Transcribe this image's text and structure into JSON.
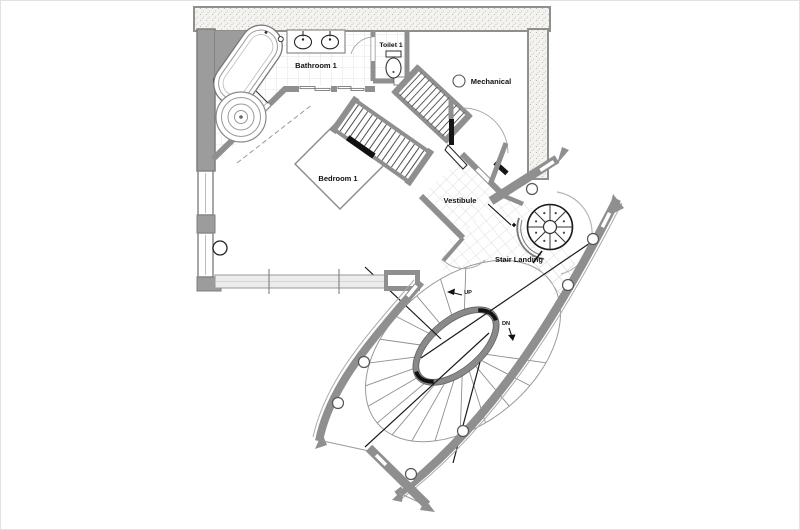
{
  "plan": {
    "rooms": [
      {
        "id": "bathroom",
        "label": "Bathroom 1"
      },
      {
        "id": "toilet",
        "label": "Toilet 1"
      },
      {
        "id": "mechanical",
        "label": "Mechanical"
      },
      {
        "id": "bedroom",
        "label": "Bedroom 1"
      },
      {
        "id": "vestibule",
        "label": "Vestibule"
      },
      {
        "id": "stair-landing",
        "label": "Stair Landing"
      }
    ],
    "annotations": {
      "up": "UP",
      "down": "DN"
    },
    "fixtures": [
      "bathtub",
      "shower",
      "vanity",
      "sinks",
      "toilet",
      "bed",
      "wardrobe",
      "spiral-stair",
      "elliptical-stair",
      "columns"
    ],
    "colors": {
      "wall": "#8f8f8f",
      "wall_solid": "#9c9c9c",
      "wall_fill": "#f4f3f0",
      "glass": "#ececec",
      "tile_line": "#dcdcdc",
      "ink": "#111111",
      "paper": "#ffffff"
    }
  }
}
